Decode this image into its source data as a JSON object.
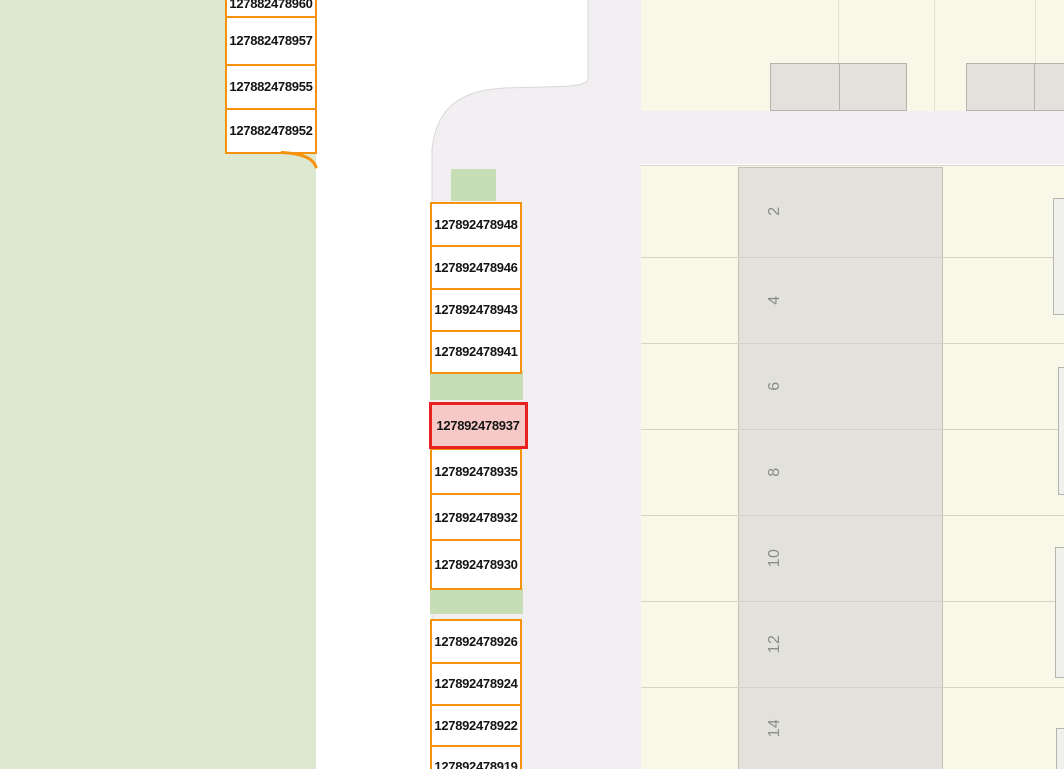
{
  "parcels": {
    "left": [
      "127882478960",
      "127882478957",
      "127882478955",
      "127882478952"
    ],
    "middle_upper": [
      "127892478948",
      "127892478946",
      "127892478943",
      "127892478941"
    ],
    "selected": "127892478937",
    "middle_mid": [
      "127892478935",
      "127892478932",
      "127892478930"
    ],
    "middle_lower": [
      "127892478926",
      "127892478924",
      "127892478922",
      "127892478919"
    ],
    "selected_state": "selected"
  },
  "houses": [
    "2",
    "4",
    "6",
    "8",
    "10",
    "12",
    "14"
  ],
  "colors": {
    "parcel_outline_orange": "#f5930f",
    "selected_outline_red": "#e7211d",
    "selected_fill_pink": "#f7c9c6",
    "grass_green": "#dde8d1",
    "grass_patch_green": "#c7ddb5",
    "residential_yellow": "#f8f8e8",
    "road_gray": "#f2eff2",
    "building_gray": "#e2e1dc",
    "house_number_gray": "#8a8d88"
  }
}
